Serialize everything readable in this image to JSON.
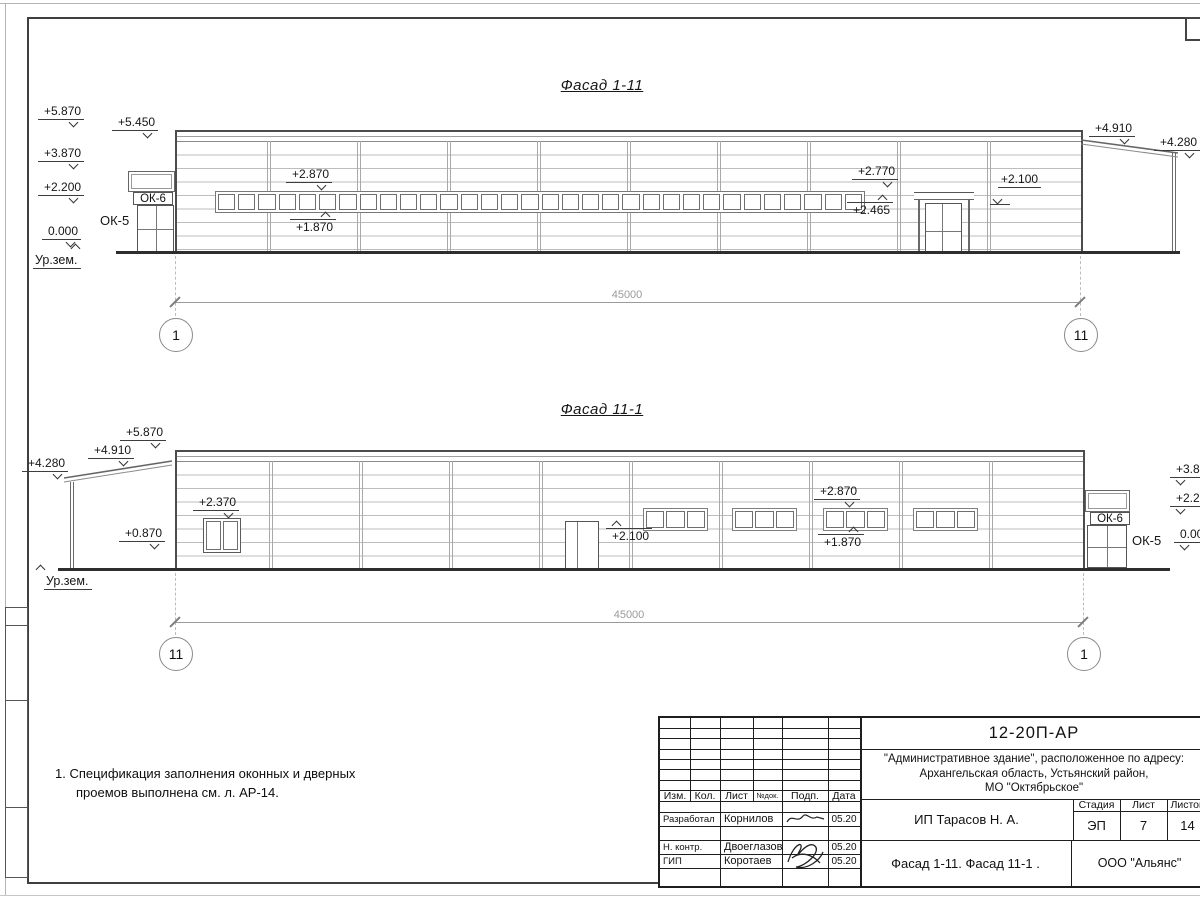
{
  "facade1": {
    "title": "Фасад 1-11",
    "dim": "45000",
    "axis_left": "1",
    "axis_right": "11",
    "ribbon_window_count": 32,
    "marks": {
      "m5870": "+5.870",
      "m5450": "+5.450",
      "m3870": "+3.870",
      "m2200": "+2.200",
      "m0000": "0.000",
      "ground": "Ур.зем.",
      "m2870": "+2.870",
      "m1870": "+1.870",
      "m2770": "+2.770",
      "m2465": "+2.465",
      "m2100": "+2.100",
      "m4910": "+4.910",
      "m4280": "+4.280",
      "ok5": "ОК-5",
      "ok6": "ОК-6"
    }
  },
  "facade2": {
    "title": "Фасад 11-1",
    "dim": "45000",
    "axis_left": "11",
    "axis_right": "1",
    "window_group_count": 4,
    "group_pane_count": 3,
    "marks": {
      "m4280": "+4.280",
      "m4910": "+4.910",
      "m5870": "+5.870",
      "m0870": "+0.870",
      "m2370": "+2.370",
      "m2100": "+2.100",
      "m2870": "+2.870",
      "m1870": "+1.870",
      "ground": "Ур.зем.",
      "right_m3870": "+3.870",
      "right_m2200": "+2.200",
      "right_m0000": "0.000",
      "ok5": "ОК-5",
      "ok6": "ОК-6"
    }
  },
  "note": {
    "line1": "1. Спецификация заполнения оконных и дверных",
    "line2": "проемов выполнена см. л. АР-14."
  },
  "titleblock": {
    "doc_number": "12-20П-АР",
    "project_line1": "\"Административное здание\", расположенное по адресу:",
    "project_line2": "Архангельская область, Устьянский район,",
    "project_line3": "МО \"Октябрьское\"",
    "columns": [
      "Изм.",
      "Кол.",
      "Лист",
      "№док.",
      "Подп.",
      "Дата"
    ],
    "rows": [
      {
        "role": "Разработал",
        "name": "Корнилов",
        "date": "05.20"
      },
      {
        "role": "Н. контр.",
        "name": "Двоеглазов",
        "date": "05.20"
      },
      {
        "role": "ГИП",
        "name": "Коротаев",
        "date": "05.20"
      }
    ],
    "client": "ИП Тарасов Н. А.",
    "stage_label": "Стадия",
    "sheet_label": "Лист",
    "sheets_label": "Листов",
    "stage": "ЭП",
    "sheet": "7",
    "sheets": "14",
    "drawing_title": "Фасад 1-11. Фасад 11-1 .",
    "company": "ООО \"Альянс\""
  }
}
